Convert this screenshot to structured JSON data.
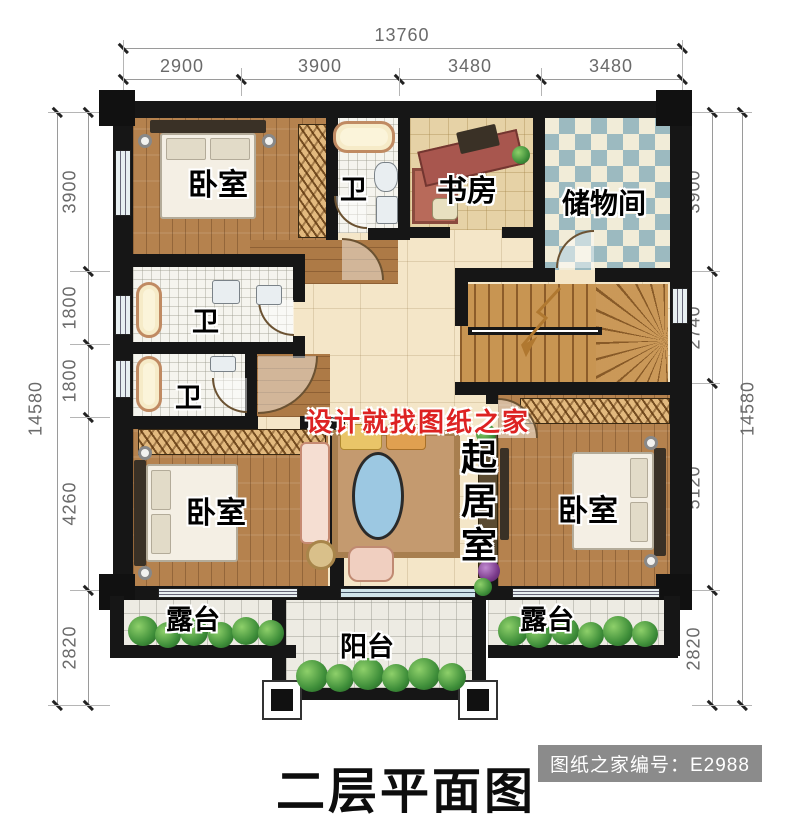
{
  "title": {
    "text": "二层平面图"
  },
  "badge": {
    "text": "图纸之家编号：E2988"
  },
  "watermark": {
    "text": "设计就找图纸之家"
  },
  "dimensions": {
    "top": {
      "total": "13760",
      "segments": [
        "2900",
        "3900",
        "3480",
        "3480"
      ]
    },
    "left": {
      "total": "14580",
      "segments": [
        "3900",
        "1800",
        "1800",
        "4260",
        "2820"
      ]
    },
    "right": {
      "total": "14580",
      "segments": [
        "3900",
        "2740",
        "5120",
        "2820"
      ]
    }
  },
  "rooms": {
    "bedroom_top_left": "卧室",
    "bath_top": "卫",
    "study": "书房",
    "storage": "储物间",
    "bath_middle": "卫",
    "bath_lower": "卫",
    "living_room": "起居室",
    "bedroom_bottom_left": "卧室",
    "bedroom_bottom_right": "卧室",
    "terrace_left": "露台",
    "terrace_right": "露台",
    "balcony": "阳台"
  },
  "colors": {
    "watermark_red": "#dd2222",
    "badge_bg": "#8b8b8b",
    "wall": "#161616",
    "wood_floor": "#b5824e",
    "storage_checker": "#9cbac0",
    "hall_floor": "#f4e6c8"
  }
}
